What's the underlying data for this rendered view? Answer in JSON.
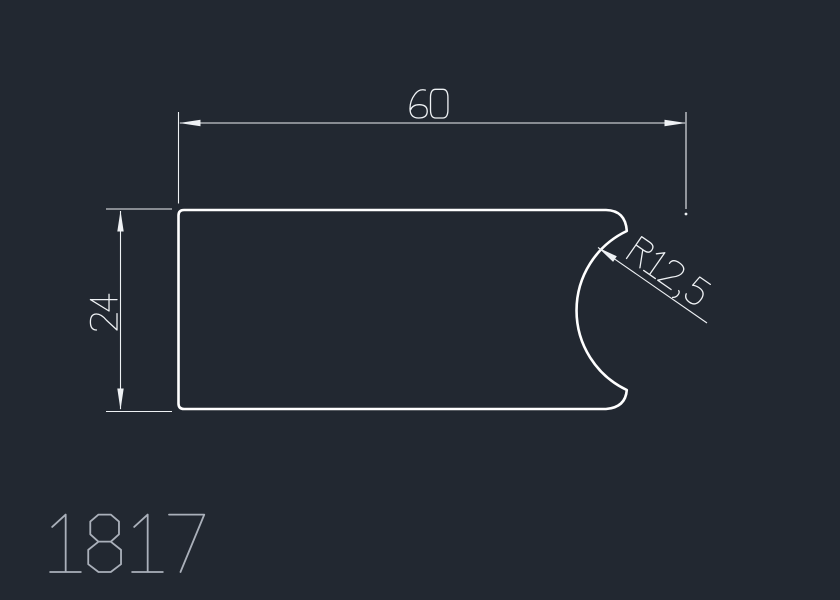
{
  "app": {
    "view": "cad-drawing-canvas"
  },
  "canvas": {
    "background_color": "#222831",
    "geometry_color": "#ffffff",
    "dimension_color": "#eef1f4",
    "label_color": "#aab0ba"
  },
  "drawing": {
    "part_number": "1817",
    "shape": "rectangular profile 60 x 24 with concave radius cut-out on right side",
    "dimensions": {
      "width": "60",
      "height": "24",
      "radius": "R12,5"
    }
  }
}
